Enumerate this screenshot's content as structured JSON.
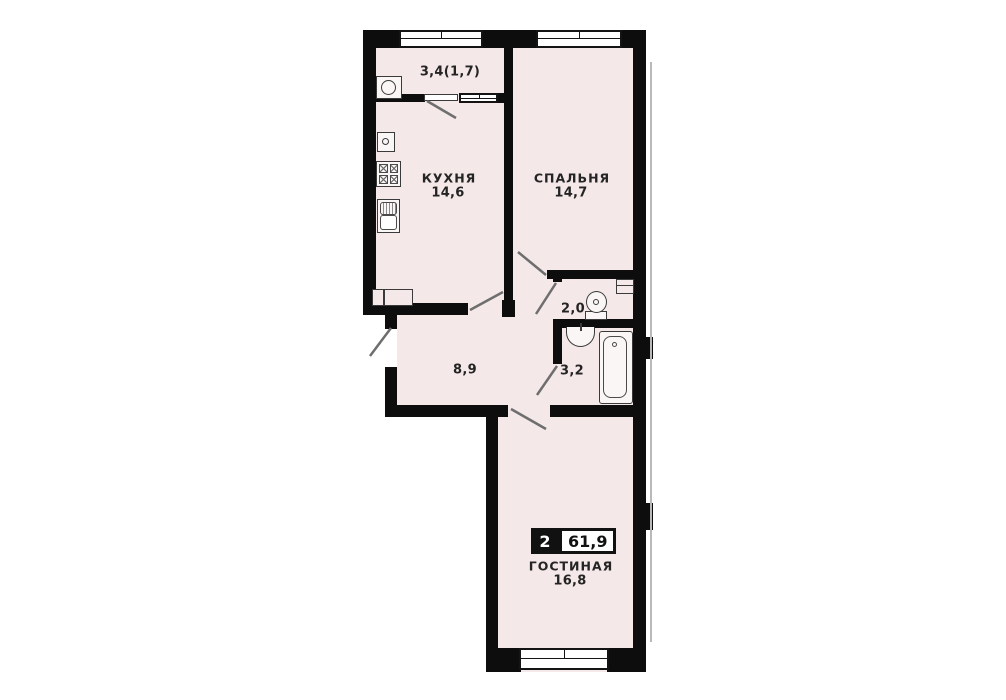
{
  "plan": {
    "type": "apartment-floor-plan",
    "colors": {
      "wall": "#0d0d0d",
      "floor": "#f4e8e8",
      "badge": "#111111",
      "background": "#ffffff"
    },
    "badge": {
      "rooms": "2",
      "total_area": "61,9"
    },
    "rooms": [
      {
        "id": "balcony",
        "area_label": "3,4(1,7)"
      },
      {
        "id": "kitchen",
        "name": "КУХНЯ",
        "area": "14,6"
      },
      {
        "id": "bedroom",
        "name": "СПАЛЬНЯ",
        "area": "14,7"
      },
      {
        "id": "toilet",
        "area": "2,0"
      },
      {
        "id": "bathroom",
        "area": "3,2"
      },
      {
        "id": "hallway",
        "area": "8,9"
      },
      {
        "id": "living",
        "name": "ГОСТИНАЯ",
        "area": "16,8"
      }
    ],
    "fixtures": [
      "washing-machine",
      "water-heater",
      "stove",
      "kitchen-sink",
      "wardrobe",
      "toilet",
      "wash-basin",
      "bathtub",
      "duct-shaft"
    ]
  }
}
